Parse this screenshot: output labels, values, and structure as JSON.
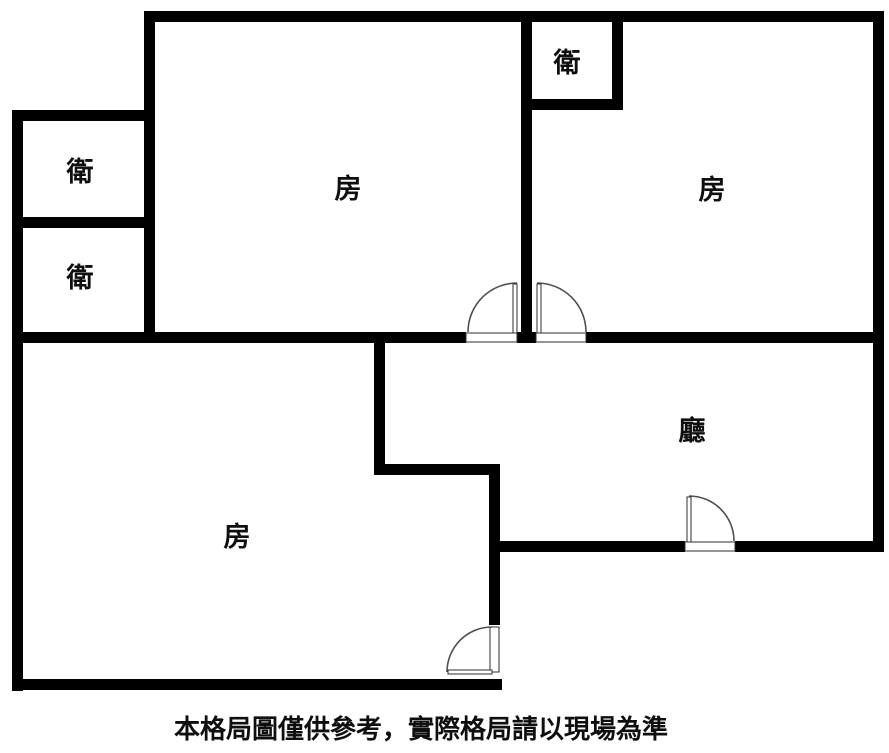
{
  "page": {
    "type": "floor-plan-diagram",
    "caption": "本格局圖僅供參考，實際格局請以現場為準"
  },
  "colors": {
    "wall": "#000000",
    "door_arc": "#4f4f4f",
    "door_frame": "#2e2e2e",
    "background": "#ffffff",
    "text": "#0f0f0f"
  },
  "rooms": [
    {
      "name": "bathroom-upper-left",
      "label": "衛"
    },
    {
      "name": "bathroom-lower-left",
      "label": "衛"
    },
    {
      "name": "bathroom-top-right",
      "label": "衛"
    },
    {
      "name": "bedroom-top-middle",
      "label": "房"
    },
    {
      "name": "bedroom-top-right",
      "label": "房"
    },
    {
      "name": "bedroom-bottom-left",
      "label": "房"
    },
    {
      "name": "living-room",
      "label": "廳"
    }
  ]
}
